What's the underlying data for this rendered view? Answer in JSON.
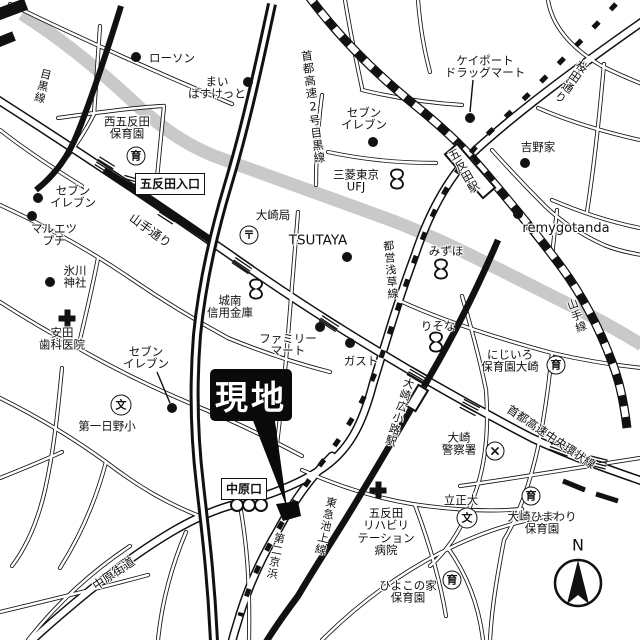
{
  "map": {
    "colors": {
      "ink": "#111111",
      "river": "#c9c9c9",
      "road_fill": "#ffffff"
    },
    "callout": {
      "text": "現地"
    },
    "compass": {
      "label": "N"
    },
    "icon_glyphs": {
      "post": "〒",
      "school": "文",
      "nursery": "育",
      "police": "×"
    },
    "boxed_labels": [
      {
        "name": "gotanda-entrance-label",
        "text": "五反田入口",
        "x": 170,
        "y": 184
      },
      {
        "name": "nakahara-exit-label",
        "text": "中原口",
        "x": 244,
        "y": 489
      }
    ],
    "labels": [
      {
        "name": "meguro-line-label",
        "lines": [
          "目黒線"
        ],
        "x": 42,
        "y": 86,
        "rot": 14,
        "vertical": true,
        "size": 11
      },
      {
        "name": "lawson-label",
        "lines": [
          "ローソン"
        ],
        "x": 172,
        "y": 58
      },
      {
        "name": "my-basket-label",
        "lines": [
          "まい",
          "ばすけっと"
        ],
        "x": 217,
        "y": 88
      },
      {
        "name": "nishigotanda-hoikuen-label",
        "lines": [
          "西五反田",
          "保育園"
        ],
        "x": 127,
        "y": 128
      },
      {
        "name": "seven-eleven-1-label",
        "lines": [
          "セブン",
          "イレブン"
        ],
        "x": 73,
        "y": 197
      },
      {
        "name": "maruetsu-petit-label",
        "lines": [
          "マルエツ",
          "プチ"
        ],
        "x": 54,
        "y": 235
      },
      {
        "name": "hikawa-jinja-label",
        "lines": [
          "氷川",
          "神社"
        ],
        "x": 75,
        "y": 277
      },
      {
        "name": "yasuda-dental-label",
        "lines": [
          "安田",
          "歯科医院"
        ],
        "x": 62,
        "y": 339
      },
      {
        "name": "yamate-dori-label",
        "lines": [
          "山手通り"
        ],
        "x": 150,
        "y": 231,
        "rot": 36,
        "size": 12
      },
      {
        "name": "shuto-2-meguro-label",
        "lines": [
          "首都高速2号目黒線"
        ],
        "x": 313,
        "y": 107,
        "rot": -7,
        "vertical": true,
        "size": 11.5
      },
      {
        "name": "osaki-post-label",
        "lines": [
          "大崎局"
        ],
        "x": 273,
        "y": 215
      },
      {
        "name": "tsutaya-label",
        "lines": [
          "TSUTAYA"
        ],
        "x": 318,
        "y": 241,
        "size": 13.5
      },
      {
        "name": "mitsubishi-ufj-label",
        "lines": [
          "三菱東京",
          "UFJ"
        ],
        "x": 356,
        "y": 181
      },
      {
        "name": "seven-eleven-2-label",
        "lines": [
          "セブン",
          "イレブン"
        ],
        "x": 364,
        "y": 119
      },
      {
        "name": "keyport-drug-label",
        "lines": [
          "ケイポート",
          "ドラッグマート"
        ],
        "x": 485,
        "y": 67
      },
      {
        "name": "yoshinoya-label",
        "lines": [
          "吉野家"
        ],
        "x": 538,
        "y": 147
      },
      {
        "name": "sakurada-dori-label",
        "lines": [
          "桜田通り"
        ],
        "x": 571,
        "y": 82,
        "rot": 35,
        "vertical": true
      },
      {
        "name": "gotanda-station-label",
        "lines": [
          "五反田駅"
        ],
        "x": 464,
        "y": 171,
        "rot": -30,
        "vertical": true
      },
      {
        "name": "remygotanda-label",
        "lines": [
          "remygotanda"
        ],
        "x": 566,
        "y": 229,
        "size": 13
      },
      {
        "name": "mizuho-label",
        "lines": [
          "みずほ"
        ],
        "x": 446,
        "y": 251
      },
      {
        "name": "risona-label",
        "lines": [
          "りそな"
        ],
        "x": 438,
        "y": 326
      },
      {
        "name": "jonan-shinkin-label",
        "lines": [
          "城南",
          "信用金庫"
        ],
        "x": 230,
        "y": 307
      },
      {
        "name": "family-mart-label",
        "lines": [
          "ファミリー",
          "マート"
        ],
        "x": 288,
        "y": 345
      },
      {
        "name": "gusto-label",
        "lines": [
          "ガスト"
        ],
        "x": 361,
        "y": 361
      },
      {
        "name": "toei-asakusa-line-label",
        "lines": [
          "都営浅草線"
        ],
        "x": 390,
        "y": 270,
        "rot": -5,
        "vertical": true,
        "size": 11
      },
      {
        "name": "nijiiro-hoikuen-label",
        "lines": [
          "にじいろ",
          "保育園大崎"
        ],
        "x": 510,
        "y": 361
      },
      {
        "name": "yamate-line-label",
        "lines": [
          "山手線"
        ],
        "x": 576,
        "y": 316,
        "rot": -20,
        "vertical": true,
        "size": 11
      },
      {
        "name": "osaki-hirokoji-station-label",
        "lines": [
          "大崎広小路駅"
        ],
        "x": 399,
        "y": 412,
        "rot": 17,
        "vertical": true,
        "size": 11
      },
      {
        "name": "osaki-police-label",
        "lines": [
          "大崎",
          "警察署"
        ],
        "x": 459,
        "y": 444
      },
      {
        "name": "shuto-chuo-kanjo-label",
        "lines": [
          "首都高速中央環状線"
        ],
        "x": 551,
        "y": 437,
        "rot": 34,
        "size": 11.5
      },
      {
        "name": "rissho-univ-label",
        "lines": [
          "立正大"
        ],
        "x": 461,
        "y": 500
      },
      {
        "name": "osaki-himawari-label",
        "lines": [
          "大崎ひまわり",
          "保育園"
        ],
        "x": 542,
        "y": 523
      },
      {
        "name": "hiyoko-hoikuen-label",
        "lines": [
          "ひよこの家",
          "保育園"
        ],
        "x": 408,
        "y": 592
      },
      {
        "name": "gotanda-rehab-label",
        "lines": [
          "五反田",
          "リハビリ",
          "テーション",
          "病院"
        ],
        "x": 386,
        "y": 532
      },
      {
        "name": "tokyu-ikegami-line-label",
        "lines": [
          "東急池上線"
        ],
        "x": 325,
        "y": 526,
        "rot": 13,
        "vertical": true,
        "size": 11
      },
      {
        "name": "daini-keihin-label",
        "lines": [
          "第二京浜"
        ],
        "x": 275,
        "y": 556,
        "rot": 11,
        "vertical": true,
        "size": 11
      },
      {
        "name": "nakahara-kaido-label",
        "lines": [
          "中原街道"
        ],
        "x": 114,
        "y": 574,
        "rot": -34,
        "size": 12
      },
      {
        "name": "daiichi-hino-label",
        "lines": [
          "第一日野小"
        ],
        "x": 107,
        "y": 426
      },
      {
        "name": "seven-eleven-3-label",
        "lines": [
          "セブン",
          "イレブン"
        ],
        "x": 146,
        "y": 358
      },
      {
        "name": "compass-n-label",
        "lines": [
          "N"
        ],
        "x": 578,
        "y": 545,
        "size": 16
      }
    ],
    "markers": [
      {
        "name": "lawson-dot",
        "type": "dot",
        "x": 136,
        "y": 57
      },
      {
        "name": "my-basket-dot",
        "type": "dot",
        "x": 248,
        "y": 82
      },
      {
        "name": "seven-eleven-1-dot",
        "type": "dot",
        "x": 38,
        "y": 198
      },
      {
        "name": "maruetsu-dot",
        "type": "dot",
        "x": 32,
        "y": 216
      },
      {
        "name": "hikawa-dot",
        "type": "dot",
        "x": 50,
        "y": 282
      },
      {
        "name": "seven-eleven-2-dot",
        "type": "dot",
        "x": 373,
        "y": 142
      },
      {
        "name": "keyport-dot",
        "type": "dot",
        "x": 470,
        "y": 118
      },
      {
        "name": "yoshinoya-dot",
        "type": "dot",
        "x": 525,
        "y": 163
      },
      {
        "name": "remygotanda-dot",
        "type": "dot",
        "x": 518,
        "y": 214
      },
      {
        "name": "tsutaya-dot",
        "type": "dot",
        "x": 347,
        "y": 257
      },
      {
        "name": "family-mart-dot",
        "type": "dot",
        "x": 320,
        "y": 327
      },
      {
        "name": "gusto-dot",
        "type": "dot",
        "x": 350,
        "y": 343
      },
      {
        "name": "seven-eleven-3-dot",
        "type": "dot",
        "x": 172,
        "y": 408
      },
      {
        "name": "ufj-bank-icon",
        "type": "bank",
        "x": 397,
        "y": 181
      },
      {
        "name": "mizuho-bank-icon",
        "type": "bank",
        "x": 441,
        "y": 271
      },
      {
        "name": "risona-bank-icon",
        "type": "bank",
        "x": 436,
        "y": 344
      },
      {
        "name": "jonan-bank-icon",
        "type": "bank",
        "x": 256,
        "y": 291
      },
      {
        "name": "osaki-post-icon",
        "type": "post",
        "x": 249,
        "y": 235
      },
      {
        "name": "hino-school-icon",
        "type": "school",
        "x": 121,
        "y": 405
      },
      {
        "name": "rissho-school-icon",
        "type": "school",
        "x": 467,
        "y": 518
      },
      {
        "name": "nishigotanda-nursery-icon",
        "type": "nursery",
        "x": 136,
        "y": 156
      },
      {
        "name": "nijiiro-nursery-icon",
        "type": "nursery",
        "x": 556,
        "y": 365
      },
      {
        "name": "himawari-nursery-icon",
        "type": "nursery",
        "x": 531,
        "y": 496
      },
      {
        "name": "hiyoko-nursery-icon",
        "type": "nursery",
        "x": 452,
        "y": 580
      },
      {
        "name": "yasuda-hospital-icon",
        "type": "hospital",
        "x": 67,
        "y": 318
      },
      {
        "name": "rehab-hospital-icon",
        "type": "hospital",
        "x": 378,
        "y": 490
      },
      {
        "name": "osaki-police-icon",
        "type": "police",
        "x": 495,
        "y": 451
      },
      {
        "name": "nakahara-signal-icon",
        "type": "signal",
        "x": 248,
        "y": 505
      },
      {
        "name": "gotanda-jr-station-marker",
        "type": "station",
        "x": 470,
        "y": 171,
        "w": 14,
        "h": 56,
        "rot": -41
      },
      {
        "name": "hirokoji-station-marker",
        "type": "station",
        "x": 417,
        "y": 398,
        "w": 9,
        "h": 22,
        "rot": 31
      }
    ]
  }
}
